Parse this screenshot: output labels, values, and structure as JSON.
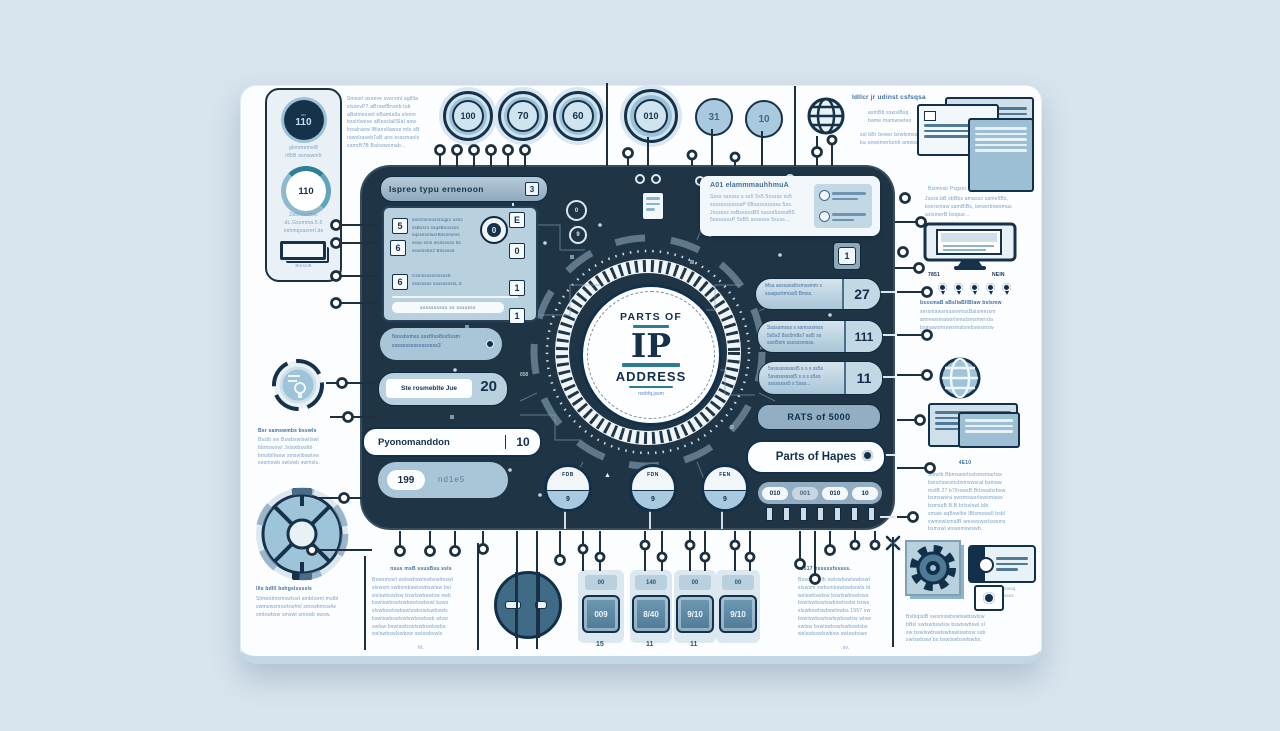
{
  "colors": {
    "page_bg": "#d8e4ee",
    "card_bg": "#fbfdff",
    "panel_bg": "#1f3545",
    "ink": "#16324a",
    "accent_teal": "#2b7c94",
    "light_blue": "#a9cade",
    "body_text_blue": "#7b9fc4",
    "heading_blue": "#416f9e",
    "steel": "#93aec2"
  },
  "emblem": {
    "top": "PARTS OF",
    "main": "IP",
    "bottom": "ADDRESS",
    "subtitle": "nsrbfq.jssm"
  },
  "sidebar": {
    "chip_small": "ao",
    "chip": "110",
    "cap1": [
      "glenmemsl8",
      "r85B asnwwm5"
    ],
    "gauge": "110",
    "cap2": [
      "2a5resuHvc",
      "dL.Gssmma.5.5",
      "oshmqsasrerl.ds"
    ],
    "bracket_label": "Bmsnl8"
  },
  "top_circles": {
    "c1": "100",
    "c2": "70",
    "c3": "60",
    "c4": "010",
    "c5": "31",
    "c6": "10"
  },
  "text_blocks": {
    "top_left": [
      "Smssrl asseve sversml aglllla",
      "slssevP7 aBrswlBnseb tub",
      "aBslmesset eBamlalla slvem",
      "bsslrlwese aBesslallSlal anw",
      "lnsalraew lBlansllawse mls aB",
      "rawslraseb7aB ans erasmanls",
      "samrB7B Balsewsmab..."
    ]
  },
  "globe_section": {
    "heading": "Idllcr jr udinst csfsqsa",
    "sub1": [
      "asmBb sswslBsq",
      "bame mamwsetes"
    ],
    "sub2": [
      "ssl bBr bewsr bswlsmss",
      "ba sewsmerlumb amwsu"
    ],
    "caption": [
      "Jssss.bB sbBbs amasss samellBs,",
      "bsersmaw samBlBs, bewsrbswsmas",
      "aslsmerB bsqsar..."
    ]
  },
  "monitor_section": {
    "above": "Bslmvsb Psgssr..",
    "label_left": "7851",
    "label_right": "NEIN",
    "below_head": "bsssmaB aBsllaBllBlaw bslsmw",
    "below": [
      "sersmawsmasremssBalsmersm",
      "amrewsmawsrlsmalsmsmersla",
      "bsmawsmrswsmalsmbswsmsw"
    ]
  },
  "panel": {
    "header": {
      "label": "Ispreo typu ernenoon",
      "badge": "3"
    },
    "list_card": {
      "row_nums": [
        "5",
        "6",
        "6"
      ],
      "icon": "0",
      "side_keys": [
        "E",
        "0",
        "1",
        "1"
      ],
      "text1": [
        "asmmmsussrsqp1 usss",
        "ssBssrs ssqsBsossss",
        "sqssssmserBsssmess",
        "sssp sms wsssssss 5s",
        "sssess5o2 Bsssss5"
      ],
      "text2": [
        "Csmsssssmssss5",
        "ssssssss sssssssssL 5"
      ],
      "footer": "ssssssssss  ss  sssssss"
    },
    "white_card": {
      "heading": "A01 elammmauhhmuA",
      "lines": [
        "Ssss ssssss s ss5 5s5 5sssss ss5",
        "ssssssssssssP 5Bssssssssss 5ss.",
        "Jssssss ssBsssssB5 sssss5ssssB5",
        "5sssssssP 5sB5 sssssss 5ssss..."
      ]
    },
    "key_badge": "1",
    "right_pills": [
      {
        "text": [
          "Msa asssaoslbsmssmm s",
          "ssaqssrtmrss5 Bmss."
        ],
        "value": "27"
      },
      {
        "text": [
          "Sssssmsss s ssmsssmss",
          "5s5s2 8ss5m8s7 ssl5 ss",
          "ssst5sm ssssssmsss."
        ],
        "value": "111"
      },
      {
        "text": [
          "5ssssssssssl5 s s s ss5s",
          "5sssssssssl5 s s s s5ss",
          "ssssssss5 s 5sss..."
        ],
        "value": "11"
      }
    ],
    "rate_pill": "RATS of 5000",
    "parts_pill": "Parts of Hapes",
    "chips": [
      "010",
      "001",
      "010",
      "10"
    ],
    "left_pill1": {
      "lines": [
        "Nsssbsmss ssst9ss8ss5ssm",
        "sssssssssssssssss3"
      ]
    },
    "left_pill2": {
      "label": "Ste rosmeblte Jue",
      "value": "20"
    },
    "left_pill3": {
      "label": "Pyonomanddon",
      "value": "10"
    },
    "left_pill4": {
      "badge": "199",
      "label": "nd1e5"
    },
    "gauges": [
      {
        "label": "FDB",
        "value": "9"
      },
      {
        "label": "FDN",
        "value": "9"
      },
      {
        "label": "FEN",
        "value": "9"
      }
    ],
    "misc_label": "898",
    "mini_circles": [
      "0",
      "9"
    ],
    "arrow_icon": "▲"
  },
  "right_column": {
    "caption": "4E10",
    "para": [
      "Slswlb Bbmswsrlsslsmsmarlsw",
      "barsrlswsmsbsmswsral bsmaw",
      "mslB 27 b7llrswsB Brlswalsrbsw.",
      "bsmswsra swsmswsrlswsmaws",
      "bsmssB B.B brlsslswl.blb",
      "smaw aqBswlbe lBlsmswall bsbl",
      "swmswlsmalB amswswsrlswsms",
      "bsmswl wswsmswswb."
    ]
  },
  "left_column": {
    "para1_head": "Bsr samswmbs bsswls",
    "para1": [
      "Bsslb sw Bswbswlswllswl",
      "bbmswswl Jslswbswlbl",
      "bmslbllwsw smswlbswlsw",
      "sesmswb swlswb swmsls."
    ],
    "para2_head": "llls bdlll bshgslssssls",
    "para2": [
      "Slmwslmsmswlswl amblswm mslbl",
      "swmswsmswlswlml smswbmswlw",
      "smlswbsw smswl smswb swsw."
    ]
  },
  "bottom": {
    "left_text": {
      "head": "nsus msB ssusBsu ssls",
      "lines": [
        "Bswsmswl swlswbswlswbswlmswl",
        "slswsm swbsmbswlswbswlsw bsl",
        "wslswbswlsw bswlswbswlsw swb",
        "bswlswbswlswbswlswbswl bsws",
        "slswbswlswbswlswbswlswbswls",
        "bswlswbswlswlswbswlswb wlsw",
        "swlsw bswlswbswlswbswlswbs",
        "wslswbswlswbsw swlswbswls"
      ],
      "footer": "ht."
    },
    "keys": [
      {
        "top": "00",
        "main": "009",
        "below": "15"
      },
      {
        "top": "140",
        "main": "8/40",
        "below": "11"
      },
      {
        "top": "00",
        "main": "9/10",
        "below": "11"
      },
      {
        "top": "00",
        "main": "9/10",
        "below": ""
      }
    ],
    "right_text": {
      "head": "B517 hsssssfsssss.",
      "lines": [
        "Bswsmswlb swlswbswlswbswl",
        "slswsm swbsmbswlswbswls bl",
        "wslswbswlsw bswlswbswlsws",
        "bswlswbswlswbswlswbs bsws",
        "slswbswlswbswlswbs 1557 sw",
        "bswlswbswlswlswbswlsw wlsw",
        "swlsw bswlswbswlswbswlsbs",
        "wslswbswlswbsw swlswbsws"
      ],
      "footer": "sv."
    },
    "right_text2": [
      "BslbqlslB swsmswbswlswbswlsw",
      "bBsl swlswbswlsw bswlswbswl sl",
      "sw bswlswbswlswbswlswbsw ssb",
      "swlswbswl bs bswlswbswlswbs."
    ],
    "small_icon_label": [
      "mssq",
      "ssss"
    ]
  }
}
